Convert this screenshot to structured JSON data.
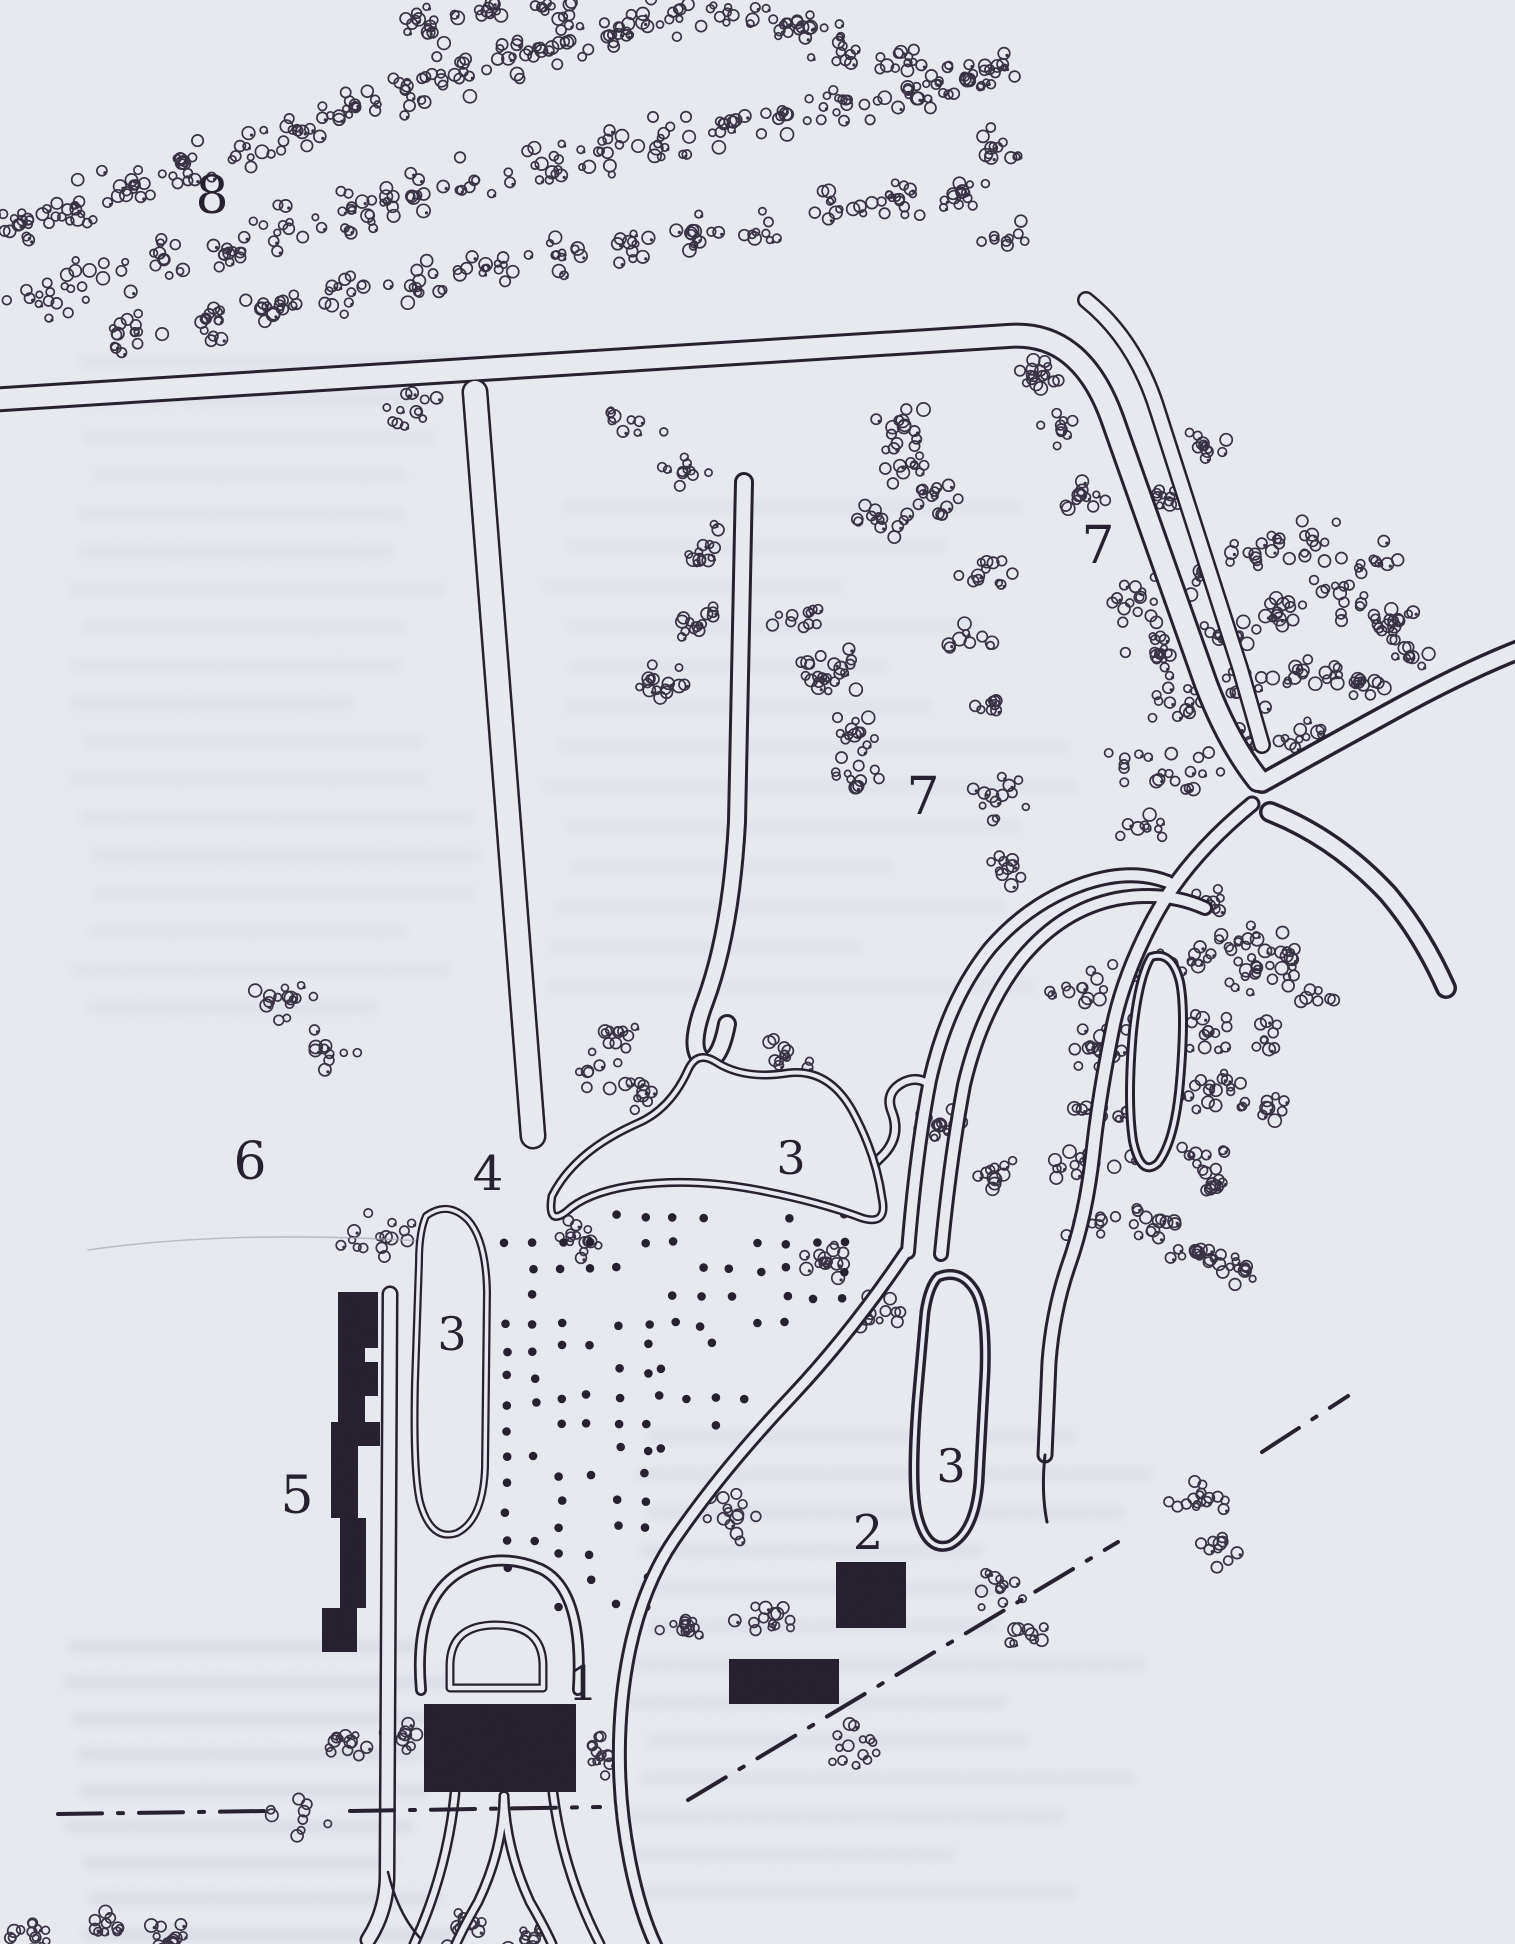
{
  "figure": {
    "name": "scanned-park-plan",
    "width": 1515,
    "height": 1944,
    "paper_color": "#e9ebf1",
    "ink_color": "#221c2b",
    "tree_ink_color": "#352e40",
    "ghost_text_color": "#b7bccf",
    "faint_line_color": "#a8a2b2"
  },
  "labels": [
    {
      "id": "8",
      "text": "8",
      "x": 212,
      "y": 196,
      "size": 52
    },
    {
      "id": "7a",
      "text": "7",
      "x": 1098,
      "y": 546,
      "size": 52
    },
    {
      "id": "7b",
      "text": "7",
      "x": 923,
      "y": 797,
      "size": 52
    },
    {
      "id": "6",
      "text": "6",
      "x": 250,
      "y": 1162,
      "size": 52
    },
    {
      "id": "3-pond",
      "text": "3",
      "x": 791,
      "y": 1158,
      "size": 46
    },
    {
      "id": "3-left",
      "text": "3",
      "x": 452,
      "y": 1334,
      "size": 46
    },
    {
      "id": "3-right",
      "text": "3",
      "x": 951,
      "y": 1466,
      "size": 46
    },
    {
      "id": "4",
      "text": "4",
      "x": 488,
      "y": 1174,
      "size": 48
    },
    {
      "id": "5",
      "text": "5",
      "x": 297,
      "y": 1496,
      "size": 52
    },
    {
      "id": "2",
      "text": "2",
      "x": 868,
      "y": 1533,
      "size": 48
    },
    {
      "id": "1",
      "text": "1",
      "x": 583,
      "y": 1684,
      "size": 48
    }
  ],
  "map": {
    "roads": [
      {
        "name": "main-road",
        "d": "M -12 400 L 1008 336 Q 1080 330 1112 418 L 1206 684 Q 1228 742 1258 780",
        "outer": 26,
        "inner": 20
      },
      {
        "name": "parallel-road",
        "d": "M 1086 300 Q 1136 340 1158 412 L 1240 668 Q 1252 710 1262 745",
        "outer": 18,
        "inner": 13
      },
      {
        "name": "junction-arm-ne",
        "d": "M 1262 783 Q 1335 742 1405 704 Q 1472 668 1524 648",
        "outer": 22,
        "inner": 15
      },
      {
        "name": "junction-arm-se",
        "d": "M 1270 812 Q 1336 838 1388 894 Q 1422 934 1446 988",
        "outer": 22,
        "inner": 15
      },
      {
        "name": "junction-arm-south",
        "d": "M 1252 804 Q 1186 858 1154 918 Q 1122 978 1112 1032 Q 1099 1096 1093 1152 Q 1086 1216 1069 1264 Q 1053 1310 1049 1362 L 1045 1455",
        "outer": 17,
        "inner": 11
      },
      {
        "name": "corridor-east",
        "d": "M 941 1254 Q 950 1160 964 1085 Q 982 1008 1022 958 Q 1062 910 1116 899 Q 1165 890 1205 908",
        "outer": 16,
        "inner": 10
      },
      {
        "name": "corridor-west",
        "d": "M 908 1252 Q 916 1152 930 1080 Q 948 1000 990 948 Q 1031 901 1086 883 Q 1132 868 1168 882",
        "outer": 16,
        "inner": 10
      },
      {
        "name": "allee",
        "d": "M 475 392 L 533 1136",
        "outer": 27,
        "inner": 22
      },
      {
        "name": "hairpin-walk",
        "d": "M 744 482 L 737 822 Q 731 932 705 1002 Q 687 1050 703 1060 Q 719 1066 727 1024",
        "outer": 20,
        "inner": 14
      },
      {
        "name": "south-drive",
        "d": "M 906 1252 Q 852 1332 792 1396 Q 722 1470 674 1540 Q 632 1602 622 1700 Q 614 1782 630 1862 Q 640 1912 656 1946",
        "outer": 15,
        "inner": 9
      },
      {
        "name": "pond-outlet",
        "d": "M 872 1210 Q 858 1178 880 1158 Q 902 1138 892 1112 Q 884 1092 904 1082 Q 918 1076 928 1084",
        "outer": 11,
        "inner": 6
      },
      {
        "name": "west-road",
        "d": "M 390 1294 L 387 1878 Q 386 1912 368 1940",
        "outer": 17,
        "inner": 12
      },
      {
        "name": "forecourt-horseshoe",
        "d": "M 421 1690 Q 413 1598 462 1571 Q 499 1551 541 1569 Q 584 1590 578 1690",
        "outer": 12,
        "inner": 6.5
      },
      {
        "name": "trident-left",
        "d": "M 455 1793 Q 447 1872 414 1944",
        "outer": 11,
        "inner": 6
      },
      {
        "name": "trident-right",
        "d": "M 553 1793 Q 563 1872 600 1944",
        "outer": 11,
        "inner": 6
      },
      {
        "name": "trident-mid-l",
        "d": "M 504 1796 Q 503 1850 478 1902 Q 463 1928 456 1944",
        "outer": 11,
        "inner": 6
      },
      {
        "name": "trident-mid-r",
        "d": "M 504 1796 Q 506 1850 530 1902 Q 545 1928 552 1944",
        "outer": 11,
        "inner": 6
      }
    ],
    "thin_lines": [
      {
        "name": "south-arm-tail",
        "d": "M 1045 1455 Q 1041 1492 1047 1522",
        "w": 3
      },
      {
        "name": "west-road-flare",
        "d": "M 388 1872 Q 398 1914 420 1938",
        "w": 2.5
      },
      {
        "name": "faint-pencil-line",
        "d": "M 88 1250 Q 240 1228 452 1243",
        "w": 1.6,
        "faint": true
      }
    ],
    "pond": {
      "d": "M 552 1196 Q 574 1152 636 1124 Q 670 1110 688 1070 Q 697 1050 716 1062 Q 744 1080 788 1073 Q 828 1068 852 1110 Q 876 1154 882 1198 Q 888 1226 862 1218 Q 820 1202 758 1190 Q 690 1177 630 1186 Q 586 1193 566 1212 Q 547 1226 552 1196 Z",
      "outer": 9,
      "inner": 4
    },
    "loops": [
      {
        "name": "loop-left",
        "d": "M 426 1216 Q 448 1200 468 1220 Q 486 1240 487 1292 L 485 1468 Q 483 1520 457 1533 Q 431 1542 420 1502 Q 413 1472 415 1382 L 419 1262 Q 419 1232 426 1216 Z",
        "outer": 8,
        "inner": 3.5
      },
      {
        "name": "loop-right-1",
        "d": "M 938 1277 Q 961 1268 975 1291 Q 987 1312 985 1372 L 979 1482 Q 975 1532 950 1545 Q 926 1553 917 1512 Q 911 1482 917 1402 L 925 1312 Q 929 1286 938 1277 Z",
        "outer": 11,
        "inner": 4
      },
      {
        "name": "loop-right-2",
        "d": "M 1151 957 Q 1172 950 1180 982 Q 1186 1012 1180 1082 Q 1175 1141 1158 1163 Q 1141 1178 1133 1141 Q 1127 1101 1133 1031 Q 1139 976 1151 957 Z",
        "outer": 10,
        "inner": 4
      }
    ],
    "dome": {
      "d": "M 450 1688 L 450 1666 Q 450 1625 496 1625 Q 543 1625 543 1666 L 543 1688 Z",
      "outer": 9,
      "inner": 4.5
    },
    "dashdot": [
      {
        "name": "boundary-west-a",
        "d": "M 58 1814 L 268 1811"
      },
      {
        "name": "boundary-west-b",
        "d": "M 350 1811 L 600 1807"
      },
      {
        "name": "boundary-diag-a",
        "d": "M 688 1800 L 1118 1542"
      },
      {
        "name": "boundary-diag-b",
        "d": "M 1262 1452 L 1348 1396"
      }
    ],
    "buildings": [
      {
        "name": "building-5",
        "rects": [
          [
            338,
            1292,
            40,
            56
          ],
          [
            338,
            1348,
            27,
            74
          ],
          [
            365,
            1362,
            13,
            34
          ],
          [
            331,
            1422,
            27,
            96
          ],
          [
            358,
            1422,
            22,
            24
          ],
          [
            340,
            1518,
            26,
            90
          ],
          [
            322,
            1608,
            35,
            44
          ]
        ]
      },
      {
        "name": "building-1",
        "rects": [
          [
            424,
            1704,
            152,
            88
          ]
        ]
      },
      {
        "name": "building-2",
        "rects": [
          [
            836,
            1562,
            70,
            66
          ]
        ]
      },
      {
        "name": "building-2b",
        "rects": [
          [
            729,
            1659,
            110,
            45
          ]
        ]
      }
    ],
    "orchard_blocks": [
      {
        "x": 505,
        "y": 1242,
        "cols": 2,
        "rows": 13,
        "sx": 30,
        "sy": 27,
        "density": 0.85
      },
      {
        "x": 563,
        "y": 1216,
        "cols": 11,
        "rows": 5,
        "sx": 28,
        "sy": 27,
        "density": 0.7
      },
      {
        "x": 560,
        "y": 1345,
        "cols": 4,
        "rows": 11,
        "sx": 29,
        "sy": 26,
        "density": 0.5
      },
      {
        "x": 658,
        "y": 1345,
        "cols": 4,
        "rows": 5,
        "sx": 28,
        "sy": 26,
        "density": 0.4
      }
    ],
    "tree_clusters": [
      [
        20,
        225,
        30
      ],
      [
        75,
        205,
        32
      ],
      [
        130,
        185,
        32
      ],
      [
        185,
        163,
        30
      ],
      [
        240,
        146,
        30
      ],
      [
        295,
        128,
        32
      ],
      [
        350,
        110,
        30
      ],
      [
        405,
        92,
        30
      ],
      [
        458,
        74,
        30
      ],
      [
        512,
        57,
        30
      ],
      [
        566,
        41,
        30
      ],
      [
        620,
        27,
        28
      ],
      [
        674,
        15,
        28
      ],
      [
        728,
        8,
        28
      ],
      [
        782,
        24,
        28
      ],
      [
        836,
        44,
        30
      ],
      [
        890,
        66,
        30
      ],
      [
        944,
        88,
        30
      ],
      [
        998,
        66,
        26
      ],
      [
        432,
        24,
        26
      ],
      [
        488,
        14,
        26
      ],
      [
        544,
        6,
        26
      ],
      [
        40,
        295,
        34
      ],
      [
        102,
        278,
        34
      ],
      [
        164,
        261,
        34
      ],
      [
        232,
        252,
        32
      ],
      [
        288,
        228,
        34
      ],
      [
        350,
        212,
        34
      ],
      [
        412,
        196,
        34
      ],
      [
        474,
        181,
        34
      ],
      [
        536,
        166,
        34
      ],
      [
        598,
        151,
        34
      ],
      [
        660,
        137,
        34
      ],
      [
        722,
        124,
        34
      ],
      [
        784,
        112,
        34
      ],
      [
        846,
        100,
        34
      ],
      [
        908,
        88,
        32
      ],
      [
        966,
        78,
        30
      ],
      [
        135,
        332,
        28
      ],
      [
        205,
        320,
        28
      ],
      [
        275,
        307,
        28
      ],
      [
        345,
        294,
        28
      ],
      [
        415,
        281,
        28
      ],
      [
        485,
        268,
        28
      ],
      [
        555,
        255,
        28
      ],
      [
        625,
        243,
        28
      ],
      [
        695,
        231,
        28
      ],
      [
        765,
        220,
        28
      ],
      [
        835,
        210,
        28
      ],
      [
        900,
        200,
        26
      ],
      [
        958,
        190,
        26
      ],
      [
        1008,
        240,
        26
      ],
      [
        990,
        150,
        28
      ],
      [
        1040,
        372,
        24
      ],
      [
        1062,
        432,
        24
      ],
      [
        1082,
        492,
        24
      ],
      [
        1160,
        495,
        30
      ],
      [
        1205,
        445,
        24
      ],
      [
        915,
        465,
        34
      ],
      [
        880,
        520,
        26
      ],
      [
        640,
        420,
        30
      ],
      [
        688,
        468,
        28
      ],
      [
        712,
        545,
        30
      ],
      [
        700,
        625,
        26
      ],
      [
        655,
        680,
        28
      ],
      [
        790,
        622,
        30
      ],
      [
        815,
        655,
        34
      ],
      [
        828,
        678,
        30
      ],
      [
        858,
        732,
        26
      ],
      [
        852,
        778,
        28
      ],
      [
        1000,
        800,
        30
      ],
      [
        1008,
        868,
        26
      ],
      [
        985,
        570,
        26
      ],
      [
        940,
        498,
        26
      ],
      [
        905,
        428,
        28
      ],
      [
        968,
        640,
        24
      ],
      [
        995,
        705,
        24
      ],
      [
        1140,
        600,
        32
      ],
      [
        1198,
        578,
        32
      ],
      [
        1256,
        558,
        32
      ],
      [
        1314,
        540,
        32
      ],
      [
        1372,
        560,
        28
      ],
      [
        1160,
        655,
        32
      ],
      [
        1218,
        635,
        32
      ],
      [
        1276,
        615,
        32
      ],
      [
        1334,
        598,
        30
      ],
      [
        1390,
        620,
        26
      ],
      [
        1186,
        710,
        32
      ],
      [
        1244,
        690,
        32
      ],
      [
        1302,
        670,
        30
      ],
      [
        1358,
        680,
        26
      ],
      [
        1136,
        764,
        30
      ],
      [
        1190,
        770,
        28
      ],
      [
        1146,
        826,
        28
      ],
      [
        1250,
        745,
        28
      ],
      [
        1300,
        730,
        26
      ],
      [
        1410,
        655,
        24
      ],
      [
        1240,
        940,
        26
      ],
      [
        1286,
        950,
        24
      ],
      [
        1210,
        905,
        24
      ],
      [
        1082,
        988,
        30
      ],
      [
        1140,
        972,
        30
      ],
      [
        1198,
        966,
        30
      ],
      [
        1256,
        972,
        30
      ],
      [
        1310,
        990,
        28
      ],
      [
        1092,
        1048,
        30
      ],
      [
        1150,
        1038,
        30
      ],
      [
        1208,
        1032,
        30
      ],
      [
        1264,
        1040,
        28
      ],
      [
        1102,
        1108,
        30
      ],
      [
        1160,
        1098,
        30
      ],
      [
        1216,
        1094,
        28
      ],
      [
        1268,
        1108,
        26
      ],
      [
        1082,
        1168,
        30
      ],
      [
        1140,
        1158,
        30
      ],
      [
        1196,
        1154,
        28
      ],
      [
        1092,
        1228,
        28
      ],
      [
        1148,
        1224,
        28
      ],
      [
        1198,
        1252,
        26
      ],
      [
        1236,
        1270,
        22
      ],
      [
        1216,
        1188,
        26
      ],
      [
        1196,
        1502,
        30
      ],
      [
        1224,
        1548,
        28
      ],
      [
        725,
        1515,
        36
      ],
      [
        688,
        1630,
        30
      ],
      [
        765,
        1615,
        28
      ],
      [
        1000,
        1590,
        30
      ],
      [
        1032,
        1634,
        28
      ],
      [
        850,
        1742,
        30
      ],
      [
        600,
        1757,
        26
      ],
      [
        828,
        1262,
        26
      ],
      [
        878,
        1312,
        26
      ],
      [
        990,
        1170,
        24
      ],
      [
        940,
        1125,
        22
      ],
      [
        345,
        1735,
        28
      ],
      [
        405,
        1735,
        20
      ],
      [
        297,
        1818,
        30
      ],
      [
        30,
        1935,
        24
      ],
      [
        100,
        1926,
        26
      ],
      [
        170,
        1938,
        24
      ],
      [
        460,
        1928,
        26
      ],
      [
        525,
        1940,
        22
      ],
      [
        285,
        1000,
        30
      ],
      [
        327,
        1046,
        30
      ],
      [
        380,
        1240,
        36
      ],
      [
        418,
        412,
        30
      ],
      [
        595,
        1075,
        30
      ],
      [
        648,
        1093,
        24
      ],
      [
        785,
        1055,
        26
      ],
      [
        575,
        1240,
        26
      ],
      [
        618,
        1032,
        22
      ]
    ],
    "ghost_text_blocks": [
      {
        "x": 65,
        "y0": 355,
        "y1": 1010,
        "step": 38,
        "wmin": 280,
        "wmax": 400,
        "op": 0.13
      },
      {
        "x": 60,
        "y0": 1640,
        "y1": 1935,
        "step": 36,
        "wmin": 300,
        "wmax": 430,
        "op": 0.22
      },
      {
        "x": 540,
        "y0": 500,
        "y1": 1000,
        "step": 40,
        "wmin": 300,
        "wmax": 560,
        "op": 0.12
      },
      {
        "x": 620,
        "y0": 1430,
        "y1": 1900,
        "step": 38,
        "wmin": 300,
        "wmax": 520,
        "op": 0.16
      }
    ]
  }
}
